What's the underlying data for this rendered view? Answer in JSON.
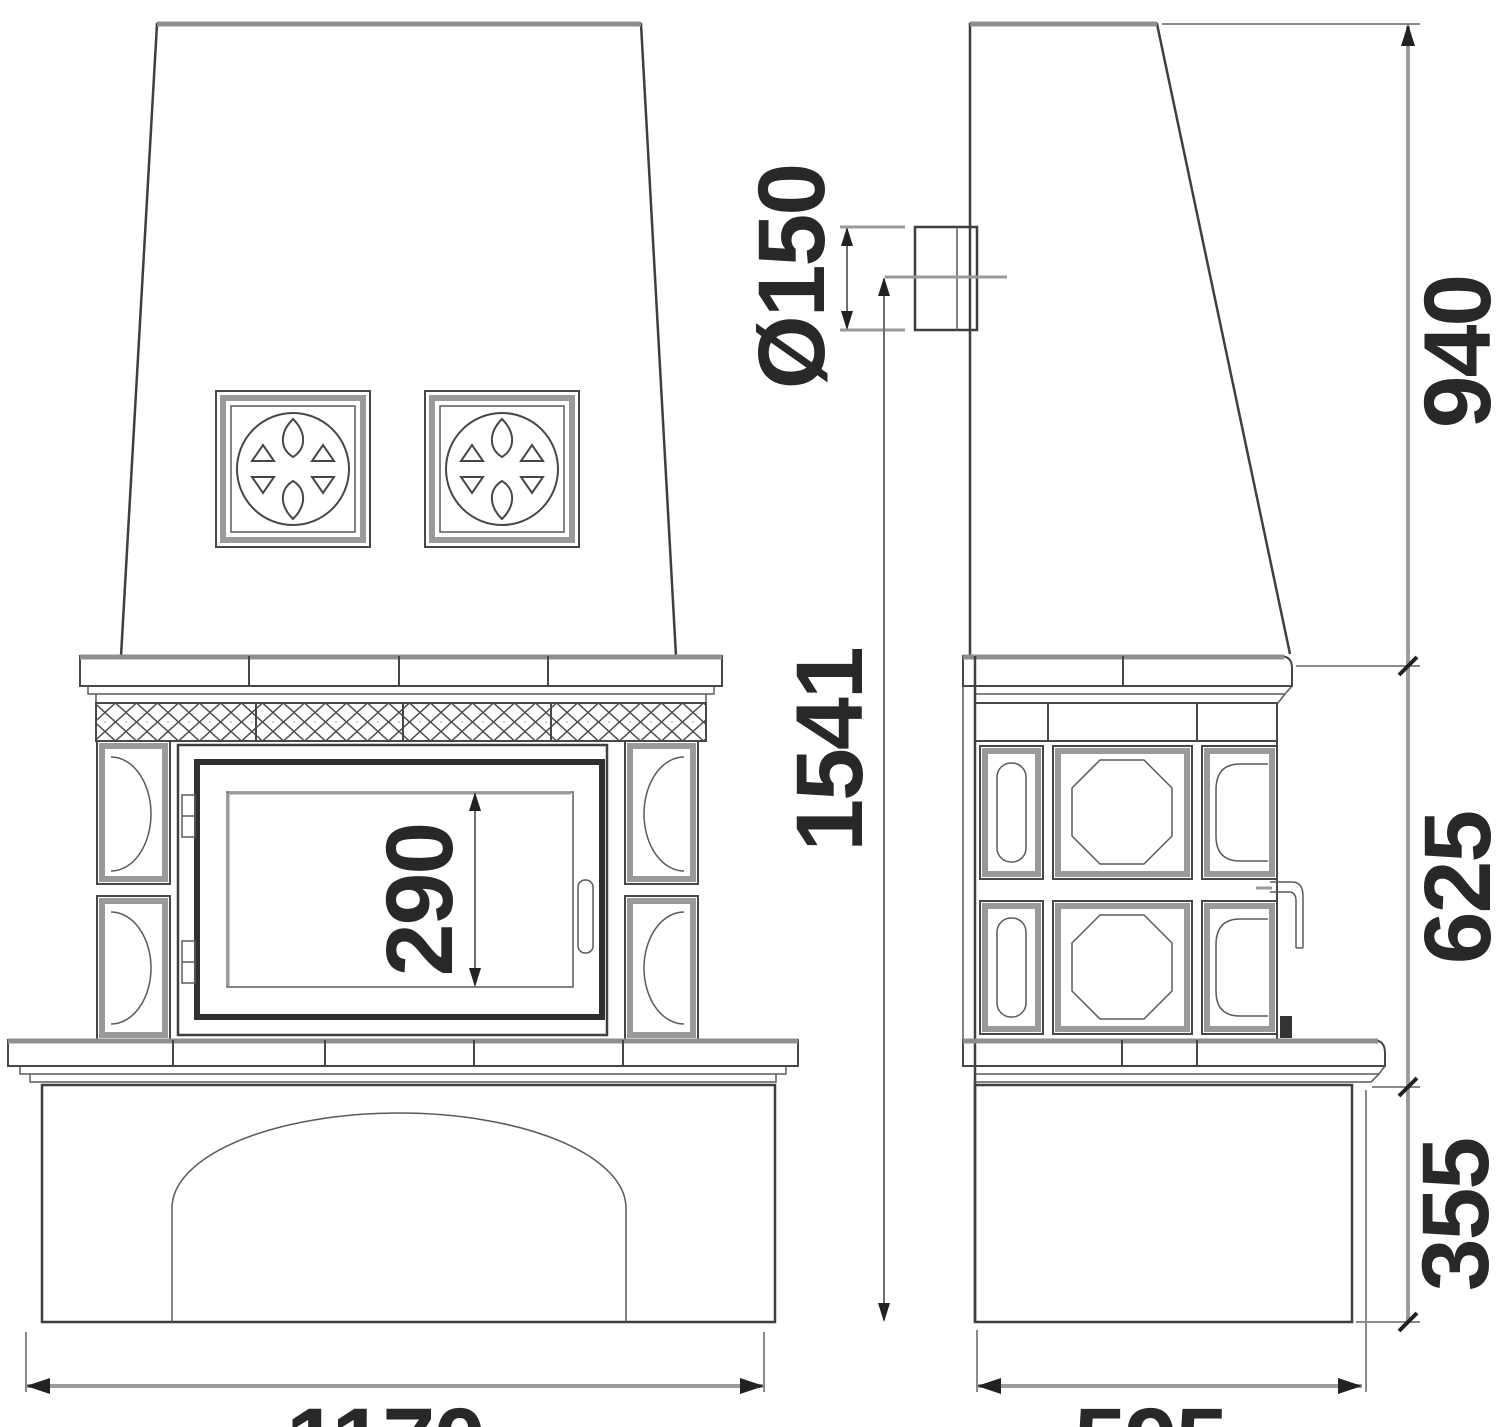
{
  "drawing": {
    "kind": "tiled stove / fireplace dimensioned technical drawing",
    "views": {
      "front": "front elevation with rosette tiles, crosshatch frieze, firebox door and arched base",
      "side": "side elevation with flue outlet, tile grid, door handle and base"
    }
  },
  "colors": {
    "background": "#ffffff",
    "line": "#474747",
    "accent_gray": "#8f8f8f",
    "dimension_gray": "#9c9c9c",
    "text": "#282828"
  },
  "dimensions": {
    "flue_diameter": {
      "label": "Ø150"
    },
    "top_section_height": {
      "label": "940"
    },
    "total_height": {
      "label": "1541"
    },
    "body_height": {
      "label": "625"
    },
    "door_glass_height": {
      "label": "290"
    },
    "base_height": {
      "label": "355"
    },
    "front_width": {
      "label": "1170"
    },
    "side_depth": {
      "label": "595"
    }
  }
}
